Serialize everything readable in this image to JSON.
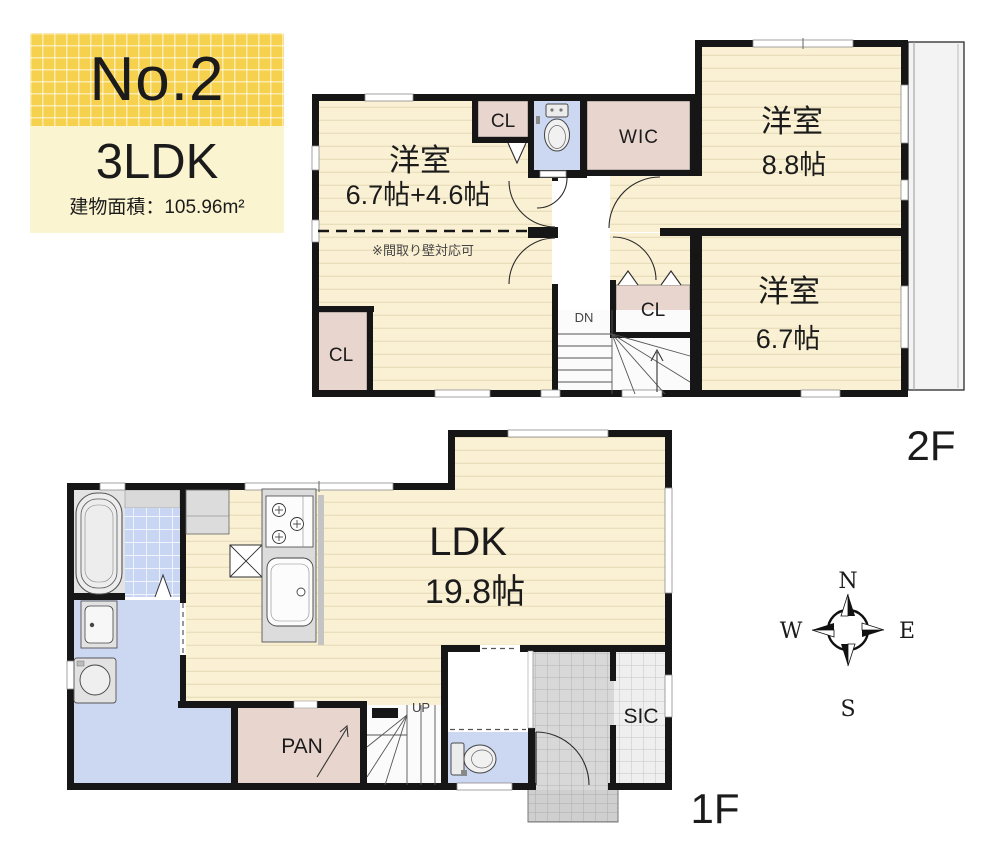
{
  "header": {
    "plan_no": "No.2",
    "layout_type": "3LDK",
    "building_area": "建物面積：105.96m²"
  },
  "floor2": {
    "label": "2F",
    "bedroom_west": {
      "name": "洋室",
      "size": "6.7帖+4.6帖"
    },
    "partition_note": "※間取り壁対応可",
    "bedroom_north": {
      "name": "洋室",
      "size": "8.8帖"
    },
    "bedroom_east": {
      "name": "洋室",
      "size": "6.7帖"
    },
    "closet": "CL",
    "walk_in_closet": "WIC",
    "stairs_down": "DN"
  },
  "floor1": {
    "label": "1F",
    "ldk": {
      "name": "LDK",
      "size": "19.8帖"
    },
    "pantry": "PAN",
    "shoe_closet": "SIC",
    "stairs_up": "UP"
  },
  "compass": {
    "north": "N",
    "east": "E",
    "south": "S",
    "west": "W"
  },
  "colors": {
    "accent_yellow": "#f6d14e",
    "pale_yellow": "#fbf4d0",
    "room_cream": "#faf0d3",
    "closet_pink": "#e8d6ce",
    "wet_area_blue": "#ccd7f2",
    "wall_black": "#161616"
  }
}
